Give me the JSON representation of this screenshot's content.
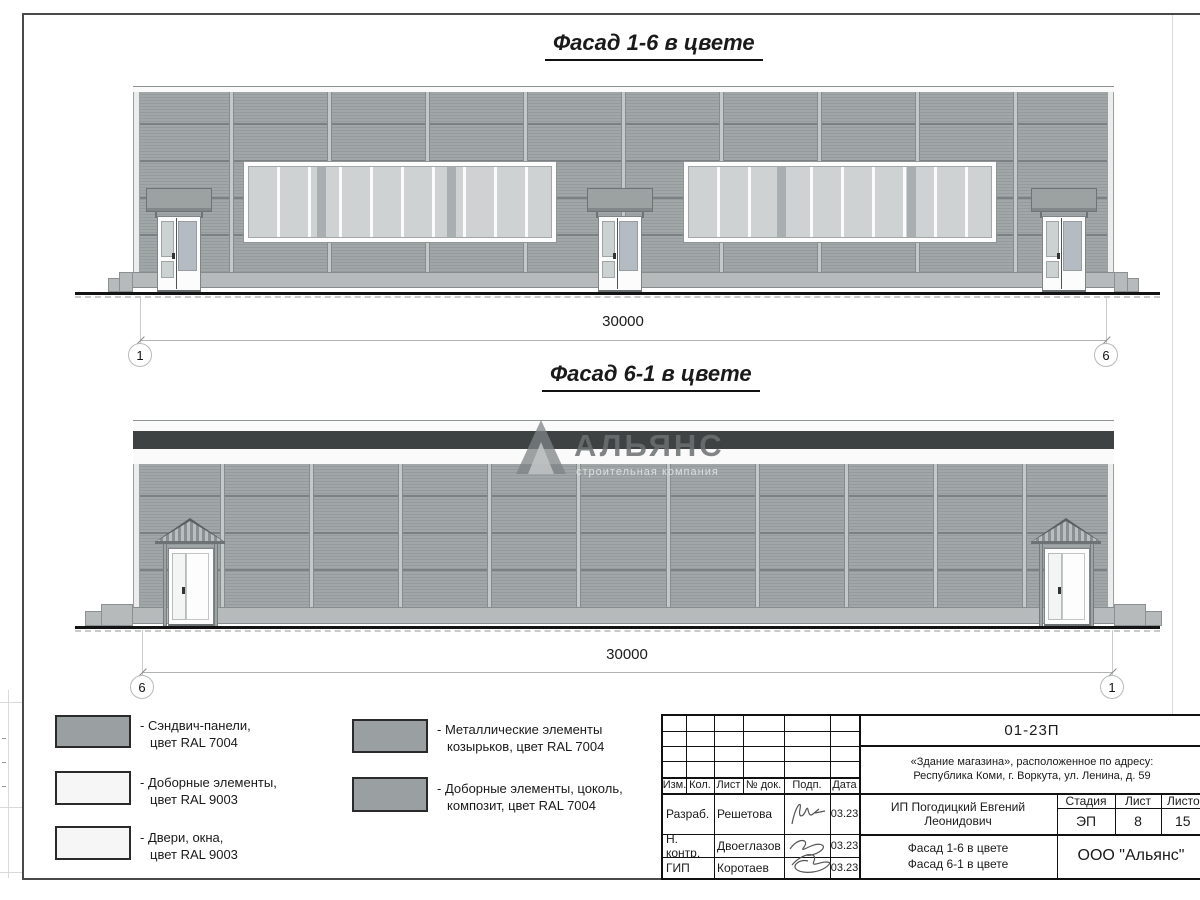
{
  "drawing": {
    "facade16_title": "Фасад 1-6 в цвете",
    "facade61_title": "Фасад 6-1 в цвете",
    "facade16": {
      "dimension": "30000",
      "axis_left": "1",
      "axis_right": "6"
    },
    "facade61": {
      "dimension": "30000",
      "axis_left": "6",
      "axis_right": "1"
    }
  },
  "watermark": {
    "title": "АЛЬЯНС",
    "subtitle": "строительная компания"
  },
  "colors": {
    "panel_ral7004": "#9aa0a1",
    "elements_ral9003": "#f6f6f6",
    "composite_band": "#3e4243"
  },
  "legend": {
    "items": [
      {
        "swatch": "gray",
        "line1": "- Сэндвич-панели,",
        "line2": "цвет RAL 7004"
      },
      {
        "swatch": "white",
        "line1": "- Доборные элементы,",
        "line2": "цвет RAL 9003"
      },
      {
        "swatch": "white",
        "line1": "- Двери, окна,",
        "line2": "цвет RAL 9003"
      },
      {
        "swatch": "gray",
        "line1": "- Металлические элементы",
        "line2": "козырьков, цвет RAL 7004"
      },
      {
        "swatch": "gray",
        "line1": "- Доборные элементы, цоколь,",
        "line2": "композит, цвет RAL 7004"
      }
    ]
  },
  "titleblock": {
    "doc_number": "01-23П",
    "object_line1": "«Здание магазина», расположенное по адресу:",
    "object_line2": "Республика Коми, г. Воркута, ул. Ленина, д. 59",
    "headers": {
      "izm": "Изм.",
      "kol": "Кол.",
      "list": "Лист",
      "doc": "№ док.",
      "podp": "Подп.",
      "data": "Дата"
    },
    "rows": [
      {
        "role": "Разраб.",
        "name": "Решетова",
        "date": "03.23"
      },
      {
        "role": "Н. контр.",
        "name": "Двоеглазов",
        "date": "03.23"
      },
      {
        "role": "ГИП",
        "name": "Коротаев",
        "date": "03.23"
      }
    ],
    "client": "ИП Погодицкий Евгений Леонидович",
    "stage_label": "Стадия",
    "sheet_label": "Лист",
    "sheets_label": "Листов",
    "stage": "ЭП",
    "sheet": "8",
    "sheets": "15",
    "sheet_title_line1": "Фасад 1-6 в цвете",
    "sheet_title_line2": "Фасад 6-1 в цвете",
    "company": "ООО \"Альянс\""
  }
}
